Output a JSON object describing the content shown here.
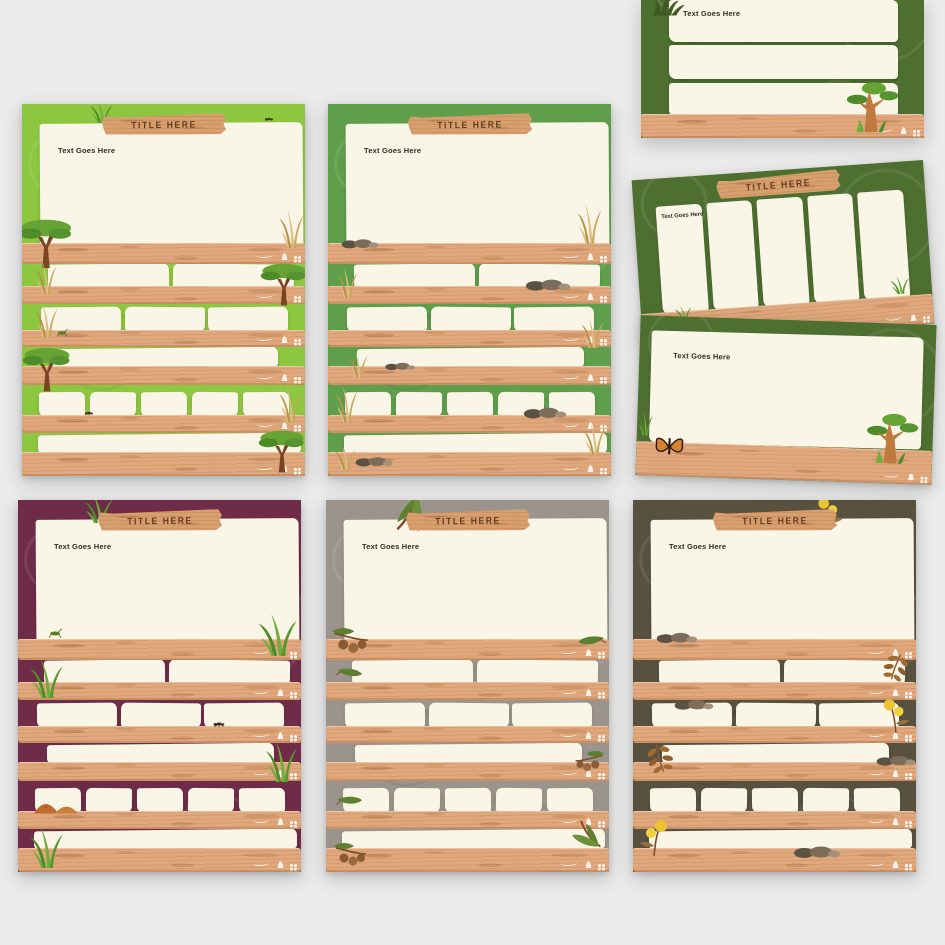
{
  "page": {
    "background_color": "#ebebeb",
    "description": "Preview sheet of eight nature-themed wood-and-paper slide templates"
  },
  "shared": {
    "wood_color": "#e0a87c",
    "banner_wood_color": "#d9a06f",
    "paper_color": "#f9f5e7",
    "title_text_color": "#5f3a1d",
    "plank_icon_labels": [
      "squiggle-trail",
      "animal-tracks"
    ]
  },
  "slides": [
    {
      "name": "portrait-lime-green",
      "background_color": "#8dc63f",
      "title": "TITLE HERE",
      "body_text": "Text Goes Here",
      "decorations": [
        "grass-tuft",
        "ant",
        "acacia-tree",
        "dry-grass",
        "grasshopper"
      ]
    },
    {
      "name": "portrait-green",
      "background_color": "#5f9e4b",
      "title": "TITLE HERE",
      "body_text": "Text Goes Here",
      "decorations": [
        "rocks",
        "dry-grass"
      ]
    },
    {
      "name": "landscape-dark-green-rows",
      "background_color": "#4d6f30",
      "body_text": "Text Goes Here",
      "decorations": [
        "grass-silhouette",
        "baobab-tree"
      ]
    },
    {
      "name": "landscape-dark-green-columns",
      "background_color": "#4d6f30",
      "title": "TITLE HERE",
      "body_text": "Text Goes Here",
      "decorations": [
        "grass-tuft"
      ]
    },
    {
      "name": "landscape-dark-green-text",
      "background_color": "#4d6f30",
      "body_text": "Text Goes Here",
      "decorations": [
        "butterfly",
        "baobab-tree",
        "grass-tuft"
      ]
    },
    {
      "name": "portrait-maroon",
      "background_color": "#6e2c49",
      "title": "TITLE HERE",
      "body_text": "Text Goes Here",
      "decorations": [
        "grass-tuft",
        "grasshopper",
        "fly",
        "dirt-mounds"
      ]
    },
    {
      "name": "portrait-gray",
      "background_color": "#9b948c",
      "title": "TITLE HERE",
      "body_text": "Text Goes Here",
      "decorations": [
        "eucalyptus-leaves",
        "gumnut-branch",
        "gum-leaf"
      ]
    },
    {
      "name": "portrait-olive",
      "background_color": "#585140",
      "title": "TITLE HERE",
      "body_text": "Text Goes Here",
      "decorations": [
        "wattle-flowers",
        "rocks",
        "autumn-leaf-branch"
      ]
    }
  ]
}
